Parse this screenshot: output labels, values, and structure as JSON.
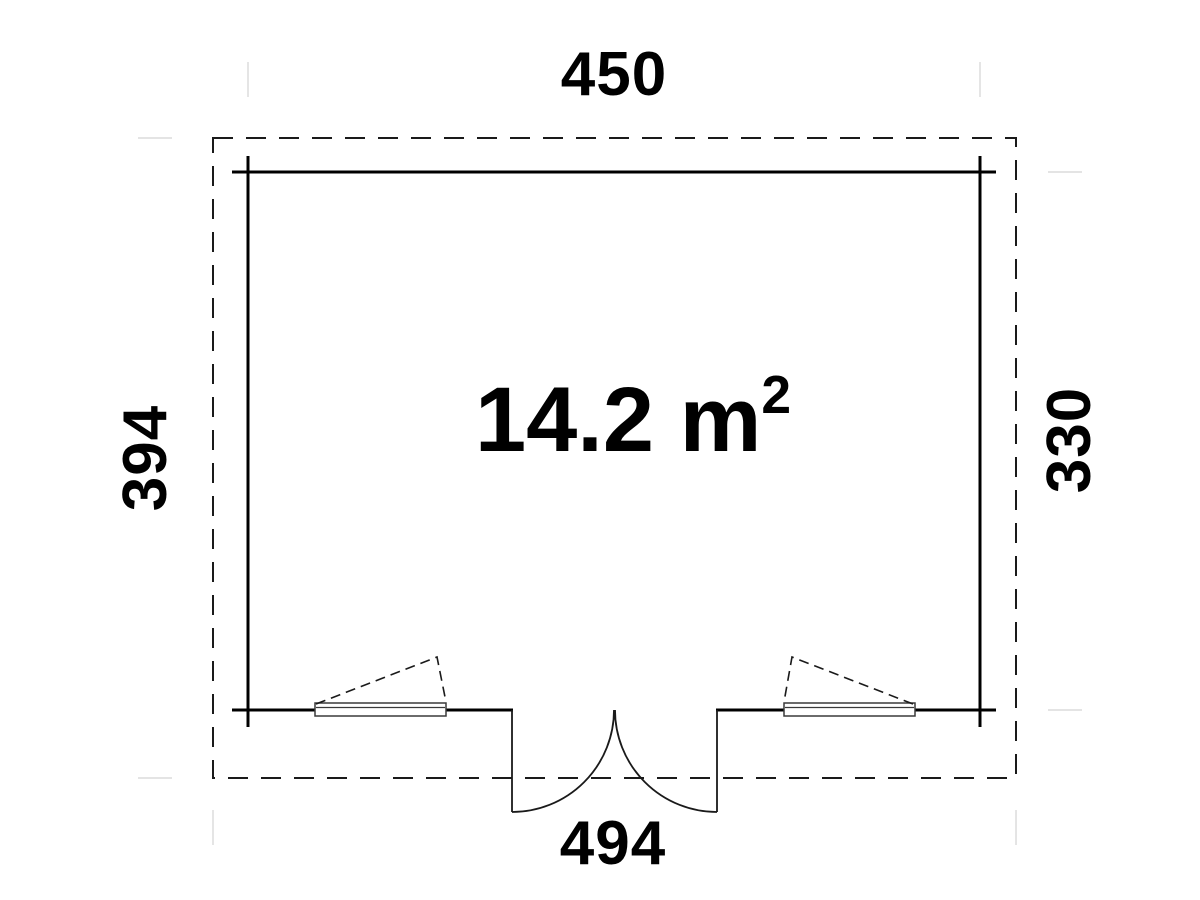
{
  "plan": {
    "dimensions": {
      "top": "450",
      "bottom": "494",
      "left": "394",
      "right": "330"
    },
    "area": {
      "label": "14.2 m",
      "sup": "2"
    },
    "colors": {
      "wall_line": "#000000",
      "roof_dashed_line": "#1a1a1a",
      "window_line": "#3a3a3a",
      "extension_line": "#dcdcdc",
      "background": "#ffffff",
      "text": "#000000"
    }
  }
}
